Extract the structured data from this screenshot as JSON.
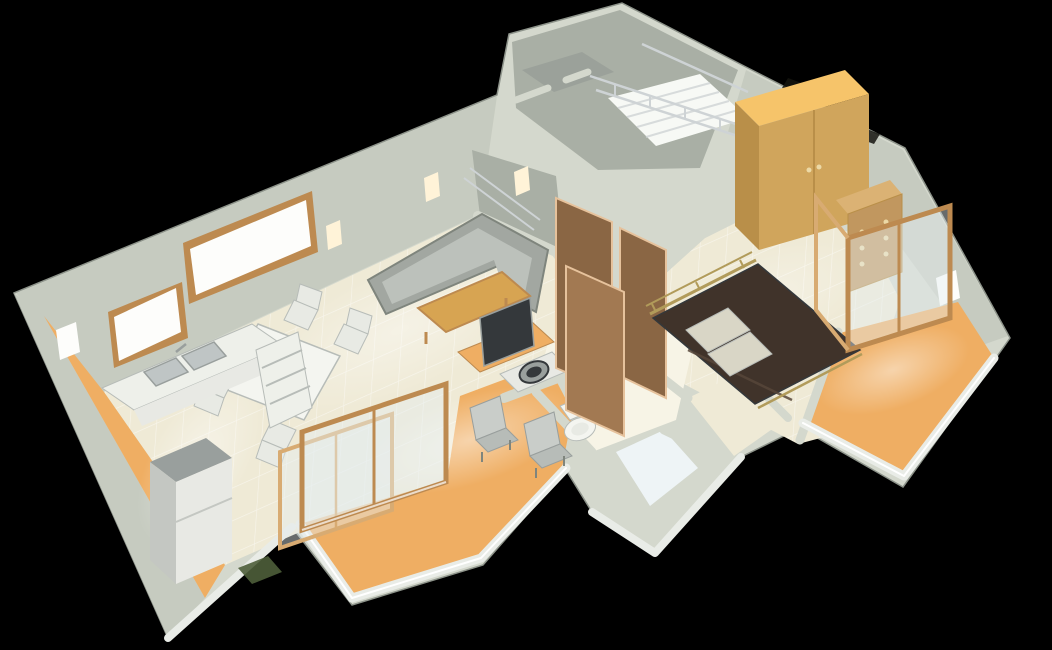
{
  "scene": {
    "type": "3d-floorplan-render",
    "title": "3D cutaway rendering of a one-bedroom apartment floor plan on a black background",
    "background": "#000000",
    "rooms": [
      "living-dining room",
      "kitchen",
      "bedroom",
      "bathroom",
      "toilet room",
      "hallway",
      "staircase",
      "front balcony",
      "rear balcony",
      "kitchen service strip"
    ],
    "furniture": [
      "corner sofa",
      "coffee table",
      "dining table with four chairs",
      "kitchen counter with double sink",
      "refrigerator",
      "tv on desk",
      "washing machine",
      "toilet",
      "wardrobe",
      "chest of drawers",
      "double bed with pillows",
      "sliding glass doors",
      "open wooden doors",
      "stair with metal railing",
      "two balcony chairs",
      "wall spotlights"
    ],
    "palette": {
      "background": "#000000",
      "wallTop": "#d4d8cd",
      "wallFace": "#c6cbc0",
      "wallFaceDark": "#a9afa5",
      "wallInner": "#9ba19a",
      "wallWhite": "#e9ece7",
      "outline": "#8d938a",
      "grout": "#ffffff",
      "floorTile": "#efead6",
      "floorTileBright": "#f7f4e6",
      "bathFloor": "#eef4f6",
      "floorOrange": "#efae63",
      "floorOrangeBright": "#ffd99c",
      "woodFrame": "#bd8a50",
      "woodFrameLight": "#d8ab72",
      "doorWood": "#8a6644",
      "doorWoodLight": "#a27952",
      "doorTrim": "#e6c29c",
      "wardrobeSide": "#b98f49",
      "wardrobeFront": "#d0a55c",
      "wardrobeTop": "#f6c46a",
      "dresserFront": "#c1975f",
      "dresserTop": "#dbb274",
      "knob": "#ecd9a6",
      "bedCover": "#40332a",
      "bedFold": "#574639",
      "pillow": "#d9d6c6",
      "brass": "#b19b5a",
      "sofaBody": "#a2a7a1",
      "sofaSeat": "#bcc1bb",
      "sofaEdge": "#7f857d",
      "tableWood": "#d7a452",
      "tableWhite": "#f4f5f0",
      "chairWhite": "#e8eae4",
      "chairGrey": "#b7bcb8",
      "chairGreyLight": "#c9cdc9",
      "counterWhite": "#eef0ea",
      "sinkGrey": "#bfc5c5",
      "applianceGrey": "#999f9d",
      "applianceWhite": "#e8e9e4",
      "applianceSide": "#c4c7c2",
      "tvDark": "#34383b",
      "metal": "#ced3d5",
      "stairLit": "#f7f9f5",
      "glass": "rgba(228,237,239,0.45)",
      "windowGlow": "#fdfdfb",
      "lightGlow": "#fff3d8",
      "ventDark": "#15150f",
      "plant": "#4e5e3a"
    }
  }
}
